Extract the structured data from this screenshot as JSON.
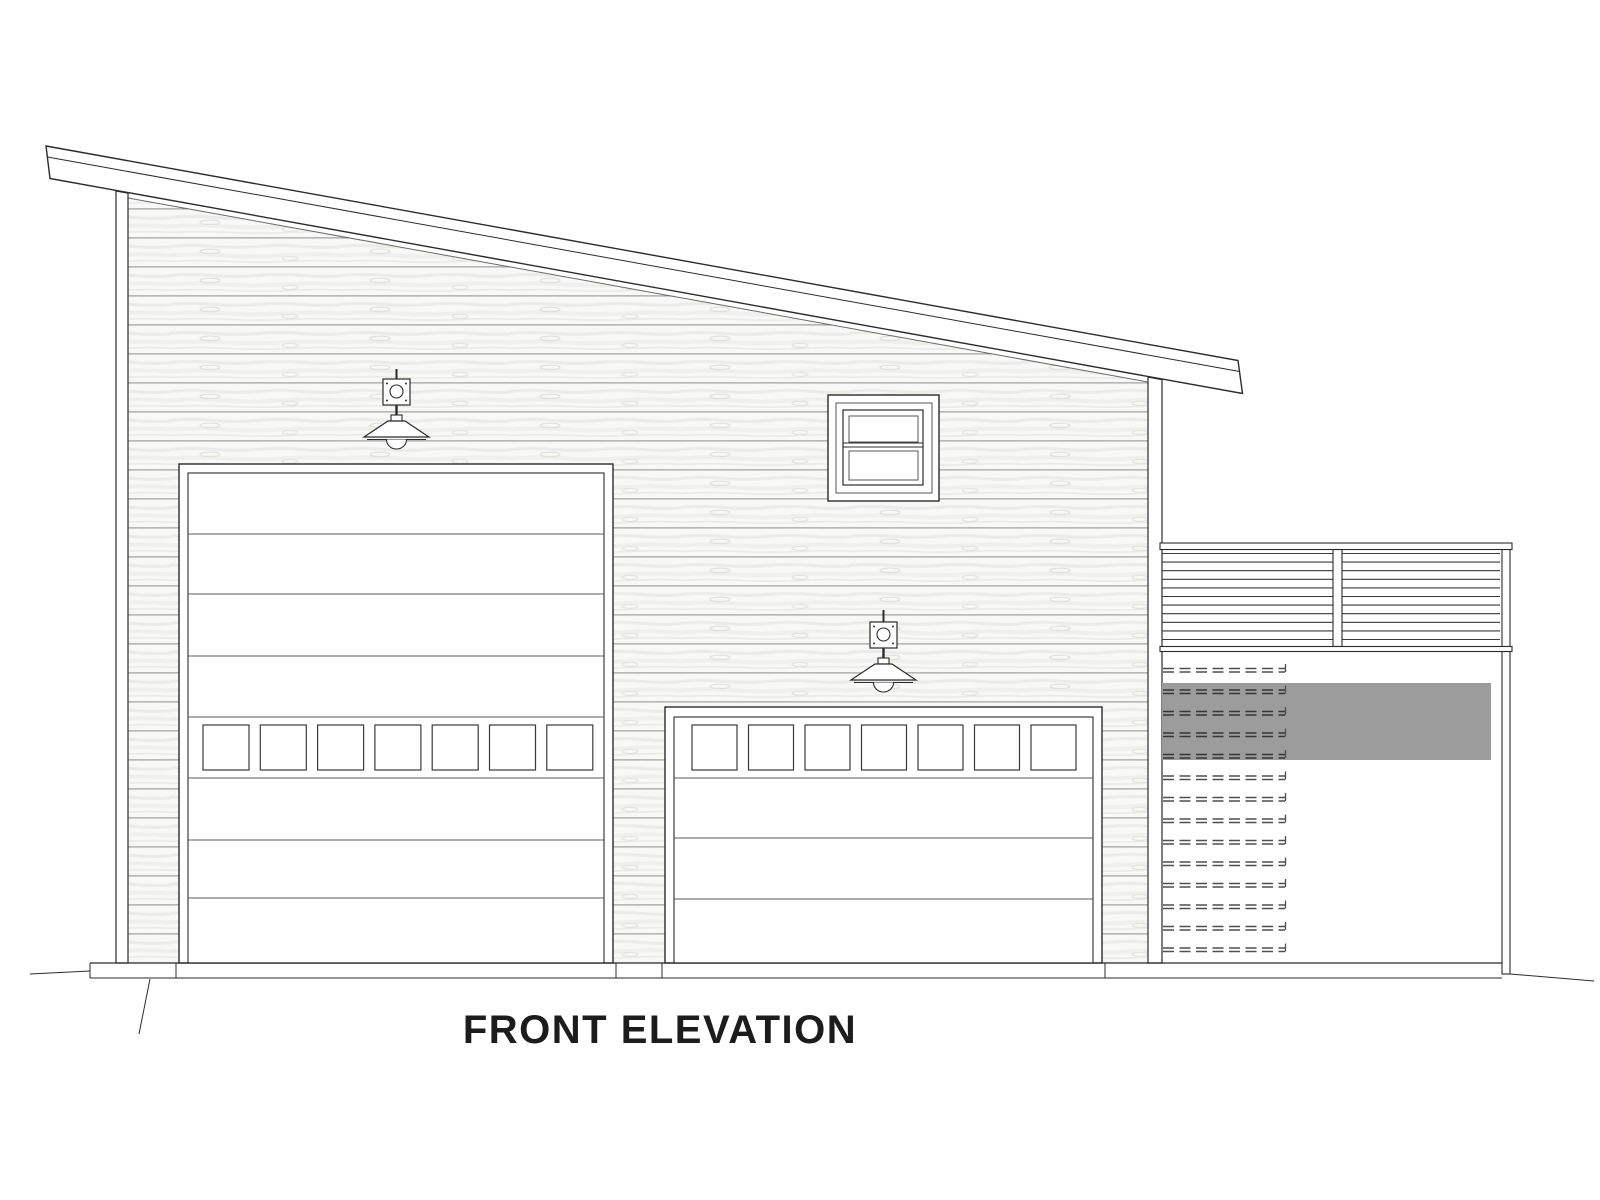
{
  "title": {
    "label": "FRONT ELEVATION"
  },
  "colors": {
    "paper": "#ffffff",
    "line": "#2b2b2b",
    "panel_line": "#5a5a5a",
    "siding_board_line": "#8d8d8d",
    "beam_shadow_gray": "#9c9c9c",
    "lattice_dash": "#4f4f4f"
  },
  "building": {
    "large_garage_door": {
      "window_count": 7,
      "windows": {
        "count": 7,
        "x_start": 203,
        "pitch": 57.3,
        "width": 46,
        "y": 725,
        "height": 45
      },
      "panel_lines_y": [
        534,
        594,
        656,
        717,
        778,
        840,
        898
      ],
      "inner": {
        "x1": 188,
        "x2": 604
      }
    },
    "small_garage_door": {
      "window_count": 7,
      "windows": {
        "count": 7,
        "x_start": 692,
        "pitch": 56.5,
        "width": 45,
        "y": 725,
        "height": 45
      },
      "panel_lines_y": [
        778,
        838,
        899
      ],
      "inner": {
        "x1": 674,
        "x2": 1093
      }
    },
    "upper_window": {
      "pane_rows": 2,
      "style": "double-hung"
    },
    "light_fixture_count": 2,
    "deck_railing": {
      "slats": {
        "count": 11,
        "y_start": 553.5,
        "pitch": 8.6,
        "x1": 1162,
        "x2": 1500
      },
      "post_count": 2
    },
    "lattice_vent": {
      "rows": {
        "count": 14,
        "y_start": 668.5,
        "pitch": 21.5,
        "x1": 1163,
        "x2": 1285,
        "double_gap": 3.5
      },
      "dash_pattern": "11 5.5"
    }
  }
}
